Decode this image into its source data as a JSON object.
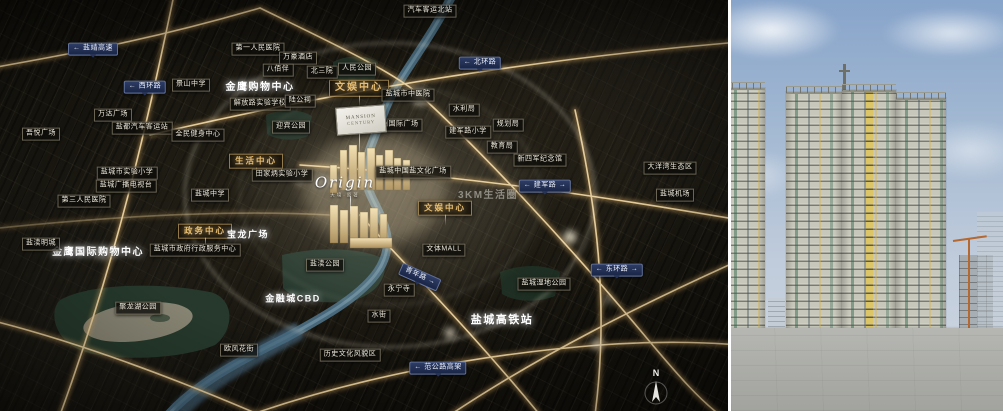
{
  "map": {
    "compass": "N",
    "project": {
      "billboard_line1": "MANSION",
      "billboard_line2": "CENTURY",
      "logo_script": "Origin",
      "logo_sub": "大境·原著"
    },
    "labels": [
      {
        "t": "← 盐靖高速",
        "x": 93,
        "y": 49,
        "k": "road"
      },
      {
        "t": "← 西环路",
        "x": 145,
        "y": 87,
        "k": "road"
      },
      {
        "t": "← 北环路",
        "x": 480,
        "y": 63,
        "k": "road"
      },
      {
        "t": "← 建军路 →",
        "x": 545,
        "y": 186,
        "k": "road"
      },
      {
        "t": "← 东环路 →",
        "x": 617,
        "y": 270,
        "k": "road"
      },
      {
        "t": "青年路 →",
        "x": 420,
        "y": 277,
        "k": "road",
        "r": 24
      },
      {
        "t": "← 范公路高架",
        "x": 438,
        "y": 368,
        "k": "road"
      },
      {
        "t": "文娱中心",
        "x": 359,
        "y": 88,
        "k": "hub",
        "fs": 10
      },
      {
        "t": "生活中心",
        "x": 256,
        "y": 161,
        "k": "hub"
      },
      {
        "t": "政务中心",
        "x": 205,
        "y": 231,
        "k": "hub"
      },
      {
        "t": "文娱中心",
        "x": 445,
        "y": 208,
        "k": "hub"
      },
      {
        "t": "金鹰购物中心",
        "x": 260,
        "y": 88,
        "k": "lg",
        "fs": 10
      },
      {
        "t": "金鹰国际购物中心",
        "x": 98,
        "y": 253,
        "k": "lg",
        "fs": 10
      },
      {
        "t": "宝龙广场",
        "x": 248,
        "y": 235,
        "k": "lg",
        "fs": 9
      },
      {
        "t": "金融城CBD",
        "x": 293,
        "y": 299,
        "k": "lg",
        "fs": 9
      },
      {
        "t": "盐城高铁站",
        "x": 502,
        "y": 321,
        "k": "lg",
        "fs": 11
      },
      {
        "t": "3KM生活圈",
        "x": 488,
        "y": 196,
        "k": "area"
      },
      {
        "t": "汽车客运北站",
        "x": 430,
        "y": 11,
        "k": "poi"
      },
      {
        "t": "第一人民医院",
        "x": 258,
        "y": 49,
        "k": "poi"
      },
      {
        "t": "万豪酒店",
        "x": 298,
        "y": 58,
        "k": "poi"
      },
      {
        "t": "八佰伴",
        "x": 278,
        "y": 70,
        "k": "poi"
      },
      {
        "t": "北三院",
        "x": 322,
        "y": 72,
        "k": "poi"
      },
      {
        "t": "人民公园",
        "x": 357,
        "y": 69,
        "k": "poi"
      },
      {
        "t": "景山中学",
        "x": 191,
        "y": 85,
        "k": "poi"
      },
      {
        "t": "解放路实验学校",
        "x": 260,
        "y": 104,
        "k": "poi"
      },
      {
        "t": "陆公祠",
        "x": 300,
        "y": 101,
        "k": "poi"
      },
      {
        "t": "盐城市中医院",
        "x": 408,
        "y": 95,
        "k": "poi"
      },
      {
        "t": "水利局",
        "x": 464,
        "y": 110,
        "k": "poi"
      },
      {
        "t": "规划局",
        "x": 508,
        "y": 125,
        "k": "poi"
      },
      {
        "t": "万达广场",
        "x": 113,
        "y": 115,
        "k": "poi"
      },
      {
        "t": "吾悦广场",
        "x": 41,
        "y": 134,
        "k": "poi"
      },
      {
        "t": "盐都汽车客运站",
        "x": 142,
        "y": 128,
        "k": "poi"
      },
      {
        "t": "全民健身中心",
        "x": 198,
        "y": 135,
        "k": "poi"
      },
      {
        "t": "盐城市实验小学",
        "x": 127,
        "y": 173,
        "k": "poi"
      },
      {
        "t": "盐城广播电视台",
        "x": 126,
        "y": 186,
        "k": "poi"
      },
      {
        "t": "盐城中学",
        "x": 210,
        "y": 195,
        "k": "poi"
      },
      {
        "t": "第三人民医院",
        "x": 84,
        "y": 201,
        "k": "poi"
      },
      {
        "t": "盐渎明城",
        "x": 41,
        "y": 244,
        "k": "poi"
      },
      {
        "t": "盐城市政府行政服务中心",
        "x": 195,
        "y": 250,
        "k": "poi"
      },
      {
        "t": "田家炳实验小学",
        "x": 282,
        "y": 175,
        "k": "poi"
      },
      {
        "t": "迎宾公园",
        "x": 291,
        "y": 127,
        "k": "poi"
      },
      {
        "t": "五洲国际广场",
        "x": 396,
        "y": 125,
        "k": "poi"
      },
      {
        "t": "建军路小学",
        "x": 468,
        "y": 132,
        "k": "poi"
      },
      {
        "t": "教育局",
        "x": 502,
        "y": 147,
        "k": "poi"
      },
      {
        "t": "新四军纪念馆",
        "x": 540,
        "y": 160,
        "k": "poi"
      },
      {
        "t": "盐城中国盐文化广场",
        "x": 413,
        "y": 172,
        "k": "poi"
      },
      {
        "t": "文体MALL",
        "x": 444,
        "y": 250,
        "k": "poi"
      },
      {
        "t": "盐渎公园",
        "x": 325,
        "y": 265,
        "k": "poi"
      },
      {
        "t": "永宁寺",
        "x": 399,
        "y": 290,
        "k": "poi"
      },
      {
        "t": "水街",
        "x": 379,
        "y": 316,
        "k": "poi"
      },
      {
        "t": "历史文化风貌区",
        "x": 350,
        "y": 355,
        "k": "poi"
      },
      {
        "t": "盐城湿地公园",
        "x": 544,
        "y": 284,
        "k": "poi"
      },
      {
        "t": "大洋湾生态区",
        "x": 670,
        "y": 168,
        "k": "poi"
      },
      {
        "t": "盐城机场",
        "x": 675,
        "y": 195,
        "k": "poi"
      },
      {
        "t": "欧风花街",
        "x": 239,
        "y": 350,
        "k": "poi"
      },
      {
        "t": "聚龙湖公园",
        "x": 138,
        "y": 308,
        "k": "poi"
      }
    ]
  },
  "colors": {
    "map_background": "#15130d",
    "road_gold": "#caa05f",
    "road_gold_bright": "#ecd3a0",
    "river_blue": "#4e7186",
    "badge_navy": "#1a2546",
    "hub_gold": "#e6bd72",
    "park_green": "#27392e",
    "project_beige": "#e8d3a2",
    "sky_blue": "#87a4ca",
    "tower_concrete": "#c7c7bb",
    "netting_green": "#34684e",
    "accent_yellow": "#d6b646",
    "crane_orange": "#b5682f",
    "ground_concrete": "#adaea9"
  }
}
